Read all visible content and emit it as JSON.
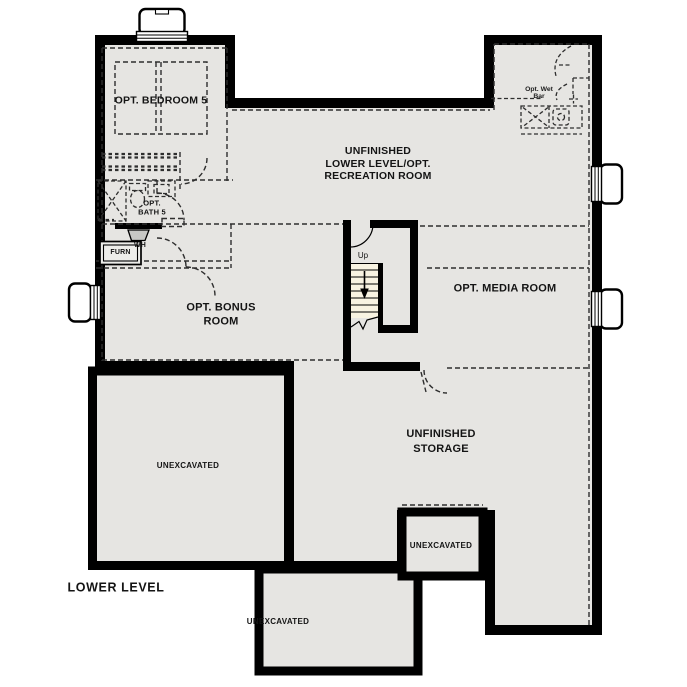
{
  "plan": {
    "title": "LOWER LEVEL"
  },
  "rooms": {
    "bedroom5": "OPT. BEDROOM 5",
    "recreation_l1": "UNFINISHED",
    "recreation_l2": "LOWER LEVEL/OPT.",
    "recreation_l3": "RECREATION ROOM",
    "bath5_l1": "OPT.",
    "bath5_l2": "BATH 5",
    "bonus_l1": "OPT. BONUS",
    "bonus_l2": "ROOM",
    "media": "OPT. MEDIA ROOM",
    "storage_l1": "UNFINISHED",
    "storage_l2": "STORAGE",
    "wetbar_l1": "Opt. Wet",
    "wetbar_l2": "Bar",
    "unexcavated_left": "UNEXCAVATED",
    "unexcavated_right": "UNEXCAVATED",
    "unexcavated_bottom": "UNEXCAVATED"
  },
  "equipment": {
    "furnace": "FURN",
    "water_heater": "WH"
  },
  "stairs": {
    "direction_label": "Up"
  },
  "colors": {
    "wall": "#000000",
    "floor": "#e6e5e2",
    "treads": "#f8f3e2",
    "dashed": "#2e2e2e",
    "wh_fill": "#c8c8c5"
  }
}
